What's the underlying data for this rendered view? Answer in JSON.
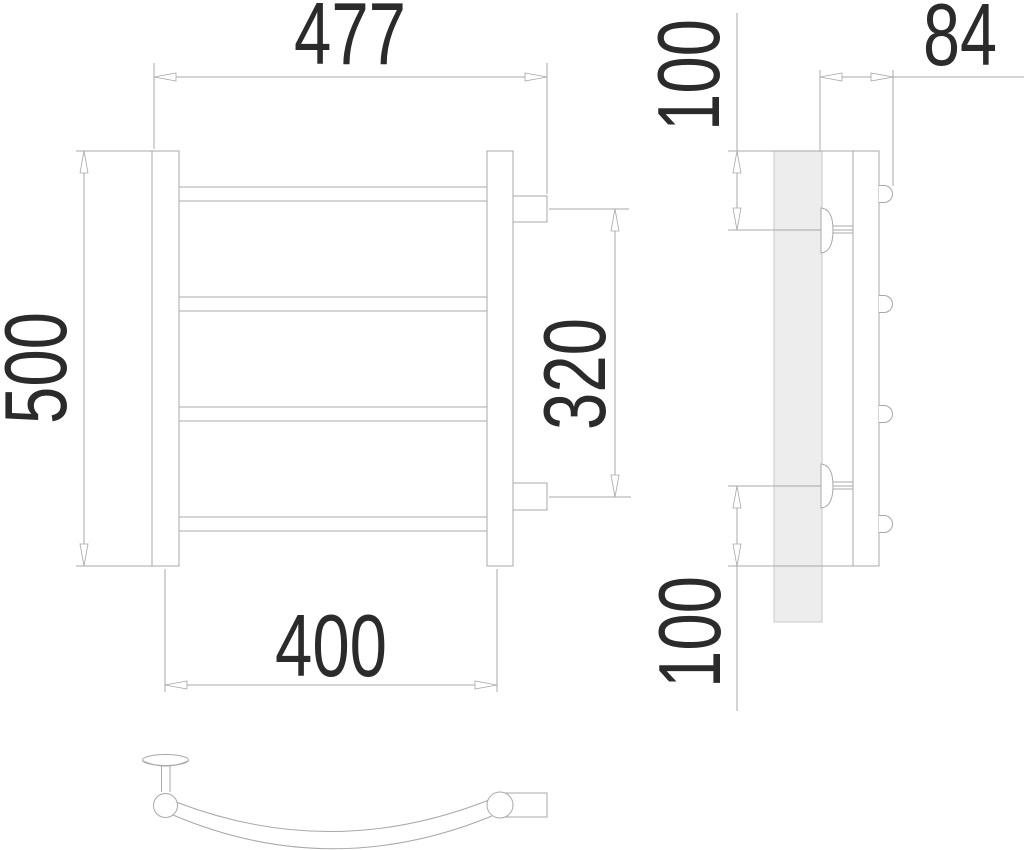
{
  "drawing": {
    "kind": "technical-drawing",
    "subject": "curved ladder towel-rail radiator, three orthographic views",
    "dimensions": {
      "overall_width": "477",
      "overall_height": "500",
      "port_spacing": "320",
      "stand_spacing": "400",
      "depth": "84",
      "top_bracket_offset": "100",
      "bottom_bracket_offset": "100"
    },
    "colors": {
      "line": "#a8a8a8",
      "text": "#2b2b2b",
      "plate_fill": "#ededed",
      "plate_line": "#c9c9c9",
      "background": "#ffffff"
    },
    "counts": {
      "front_rails": 4,
      "side_pipe_ends": 4,
      "wall_brackets": 2
    }
  }
}
